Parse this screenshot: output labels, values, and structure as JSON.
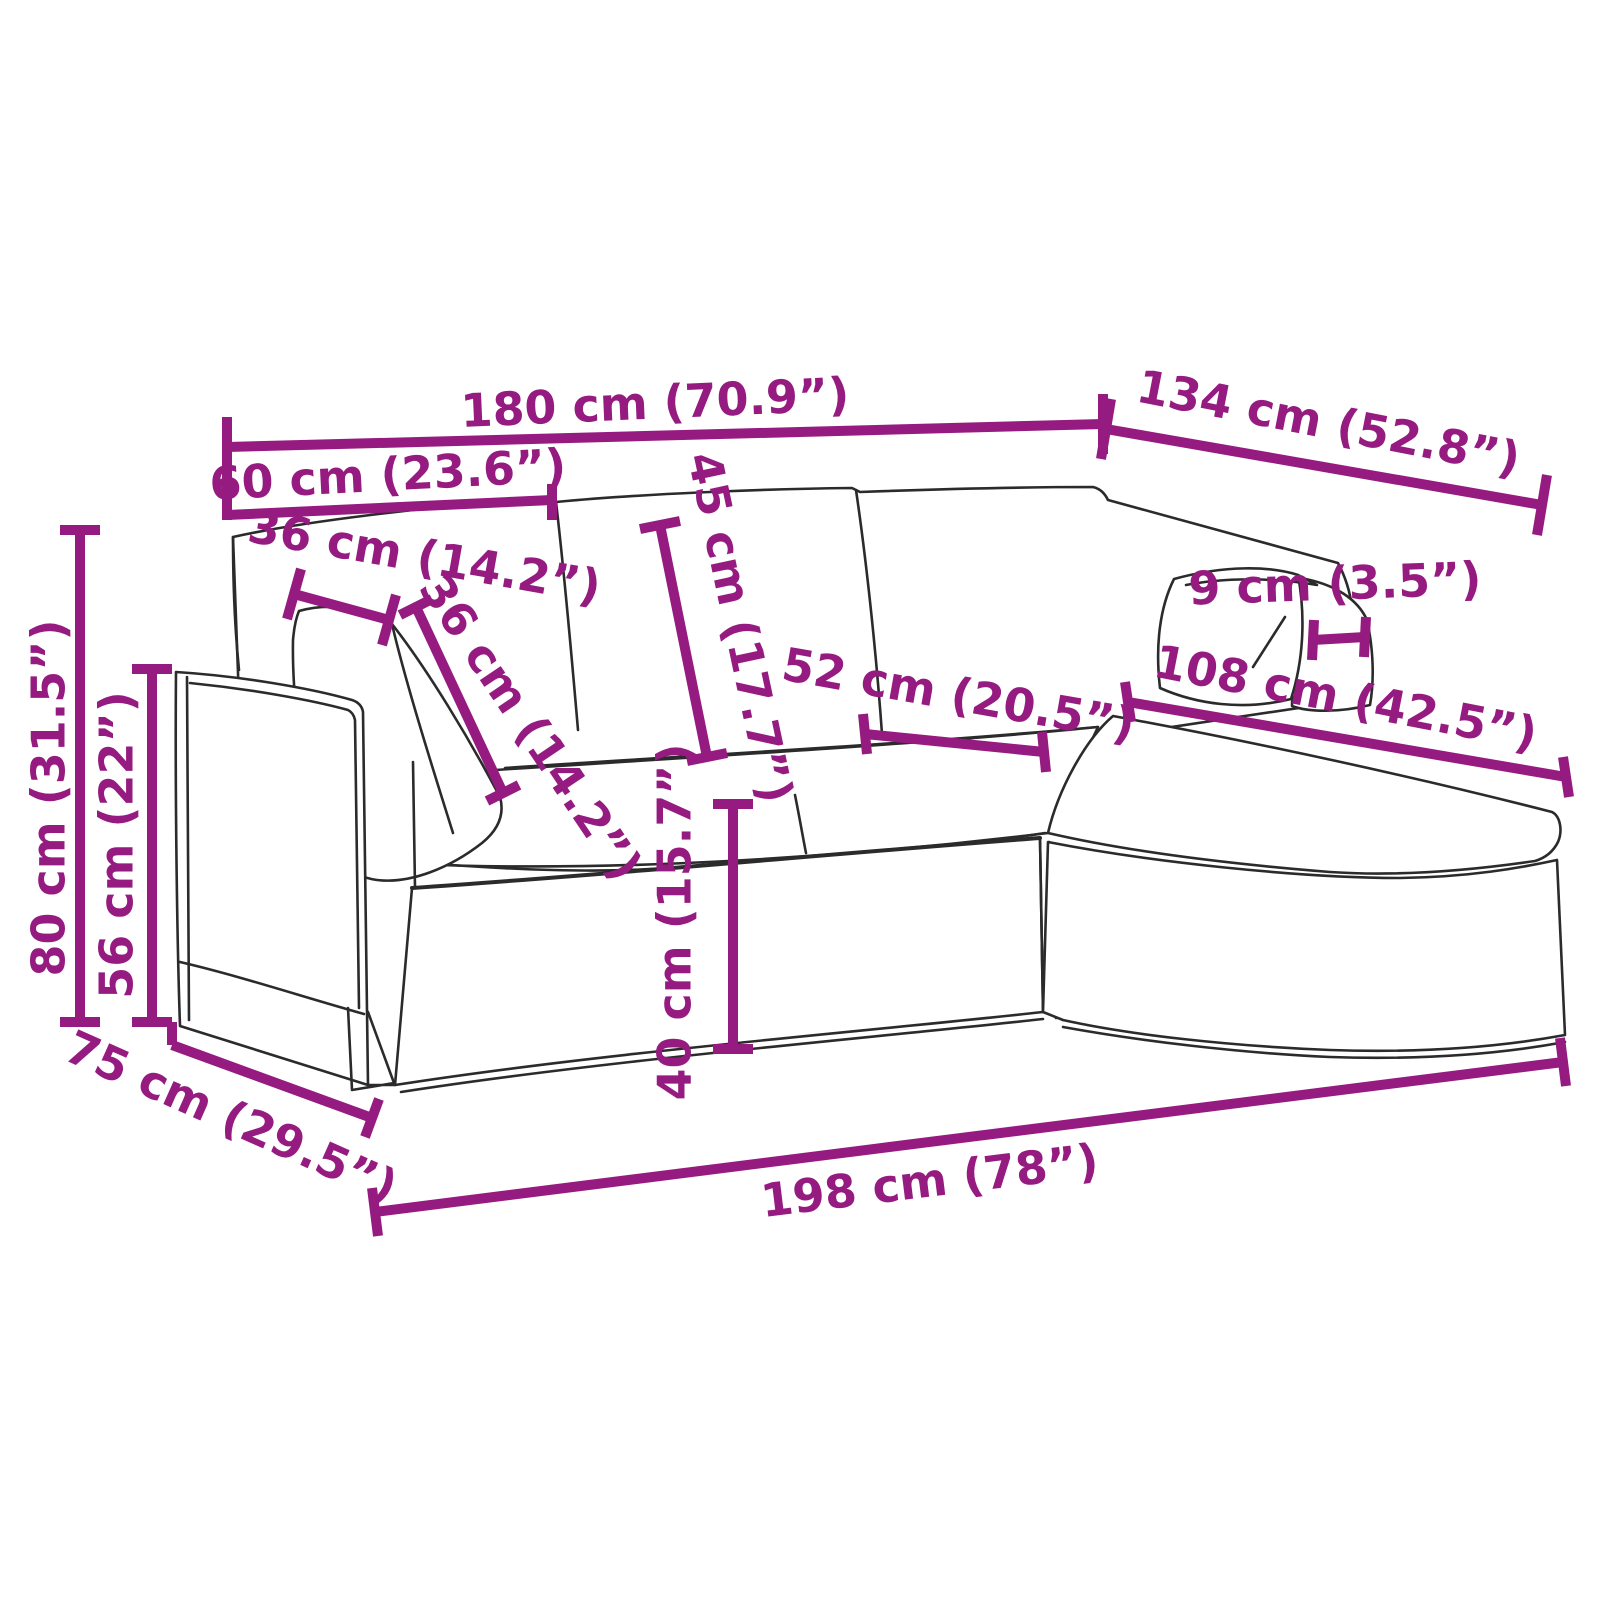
{
  "diagram": {
    "title": "Sofa dimension diagram",
    "product": "L-shaped 3-seater sofa with chaise longue and throw pillows",
    "style": "black outline drawing with magenta dimension callouts",
    "background_color": "#FFFFFF",
    "accent_color": "#951B81",
    "line_color": "#2B2B2B"
  },
  "measurements": [
    {
      "id": "total-width",
      "value_cm": 180,
      "value_in": "70.9",
      "label": "180 cm (70.9”)"
    },
    {
      "id": "chaise-outer-depth",
      "value_cm": 134,
      "value_in": "52.8",
      "label": "134 cm (52.8”)"
    },
    {
      "id": "left-section-width",
      "value_cm": 60,
      "value_in": "23.6",
      "label": "60 cm (23.6”)"
    },
    {
      "id": "pillow-width",
      "value_cm": 36,
      "value_in": "14.2",
      "label": "36 cm (14.2”)"
    },
    {
      "id": "pillow-height",
      "value_cm": 36,
      "value_in": "14.2",
      "label": "36 cm (14.2”)"
    },
    {
      "id": "backrest-cushion-height",
      "value_cm": 45,
      "value_in": "17.7",
      "label": "45 cm (17.7”)"
    },
    {
      "id": "seat-depth",
      "value_cm": 52,
      "value_in": "20.5",
      "label": "52 cm (20.5”)"
    },
    {
      "id": "chaise-length",
      "value_cm": 108,
      "value_in": "42.5",
      "label": "108 cm (42.5”)"
    },
    {
      "id": "pillow-thickness",
      "value_cm": 9,
      "value_in": "3.5",
      "label": "9 cm (3.5”)"
    },
    {
      "id": "total-height",
      "value_cm": 80,
      "value_in": "31.5",
      "label": "80 cm (31.5”)"
    },
    {
      "id": "armrest-height",
      "value_cm": 56,
      "value_in": "22",
      "label": "56 cm (22”)"
    },
    {
      "id": "seat-height",
      "value_cm": 40,
      "value_in": "15.7",
      "label": "40 cm (15.7”)"
    },
    {
      "id": "base-depth",
      "value_cm": 75,
      "value_in": "29.5",
      "label": "75 cm (29.5”)"
    },
    {
      "id": "total-length",
      "value_cm": 198,
      "value_in": "78",
      "label": "198 cm (78”)"
    }
  ]
}
